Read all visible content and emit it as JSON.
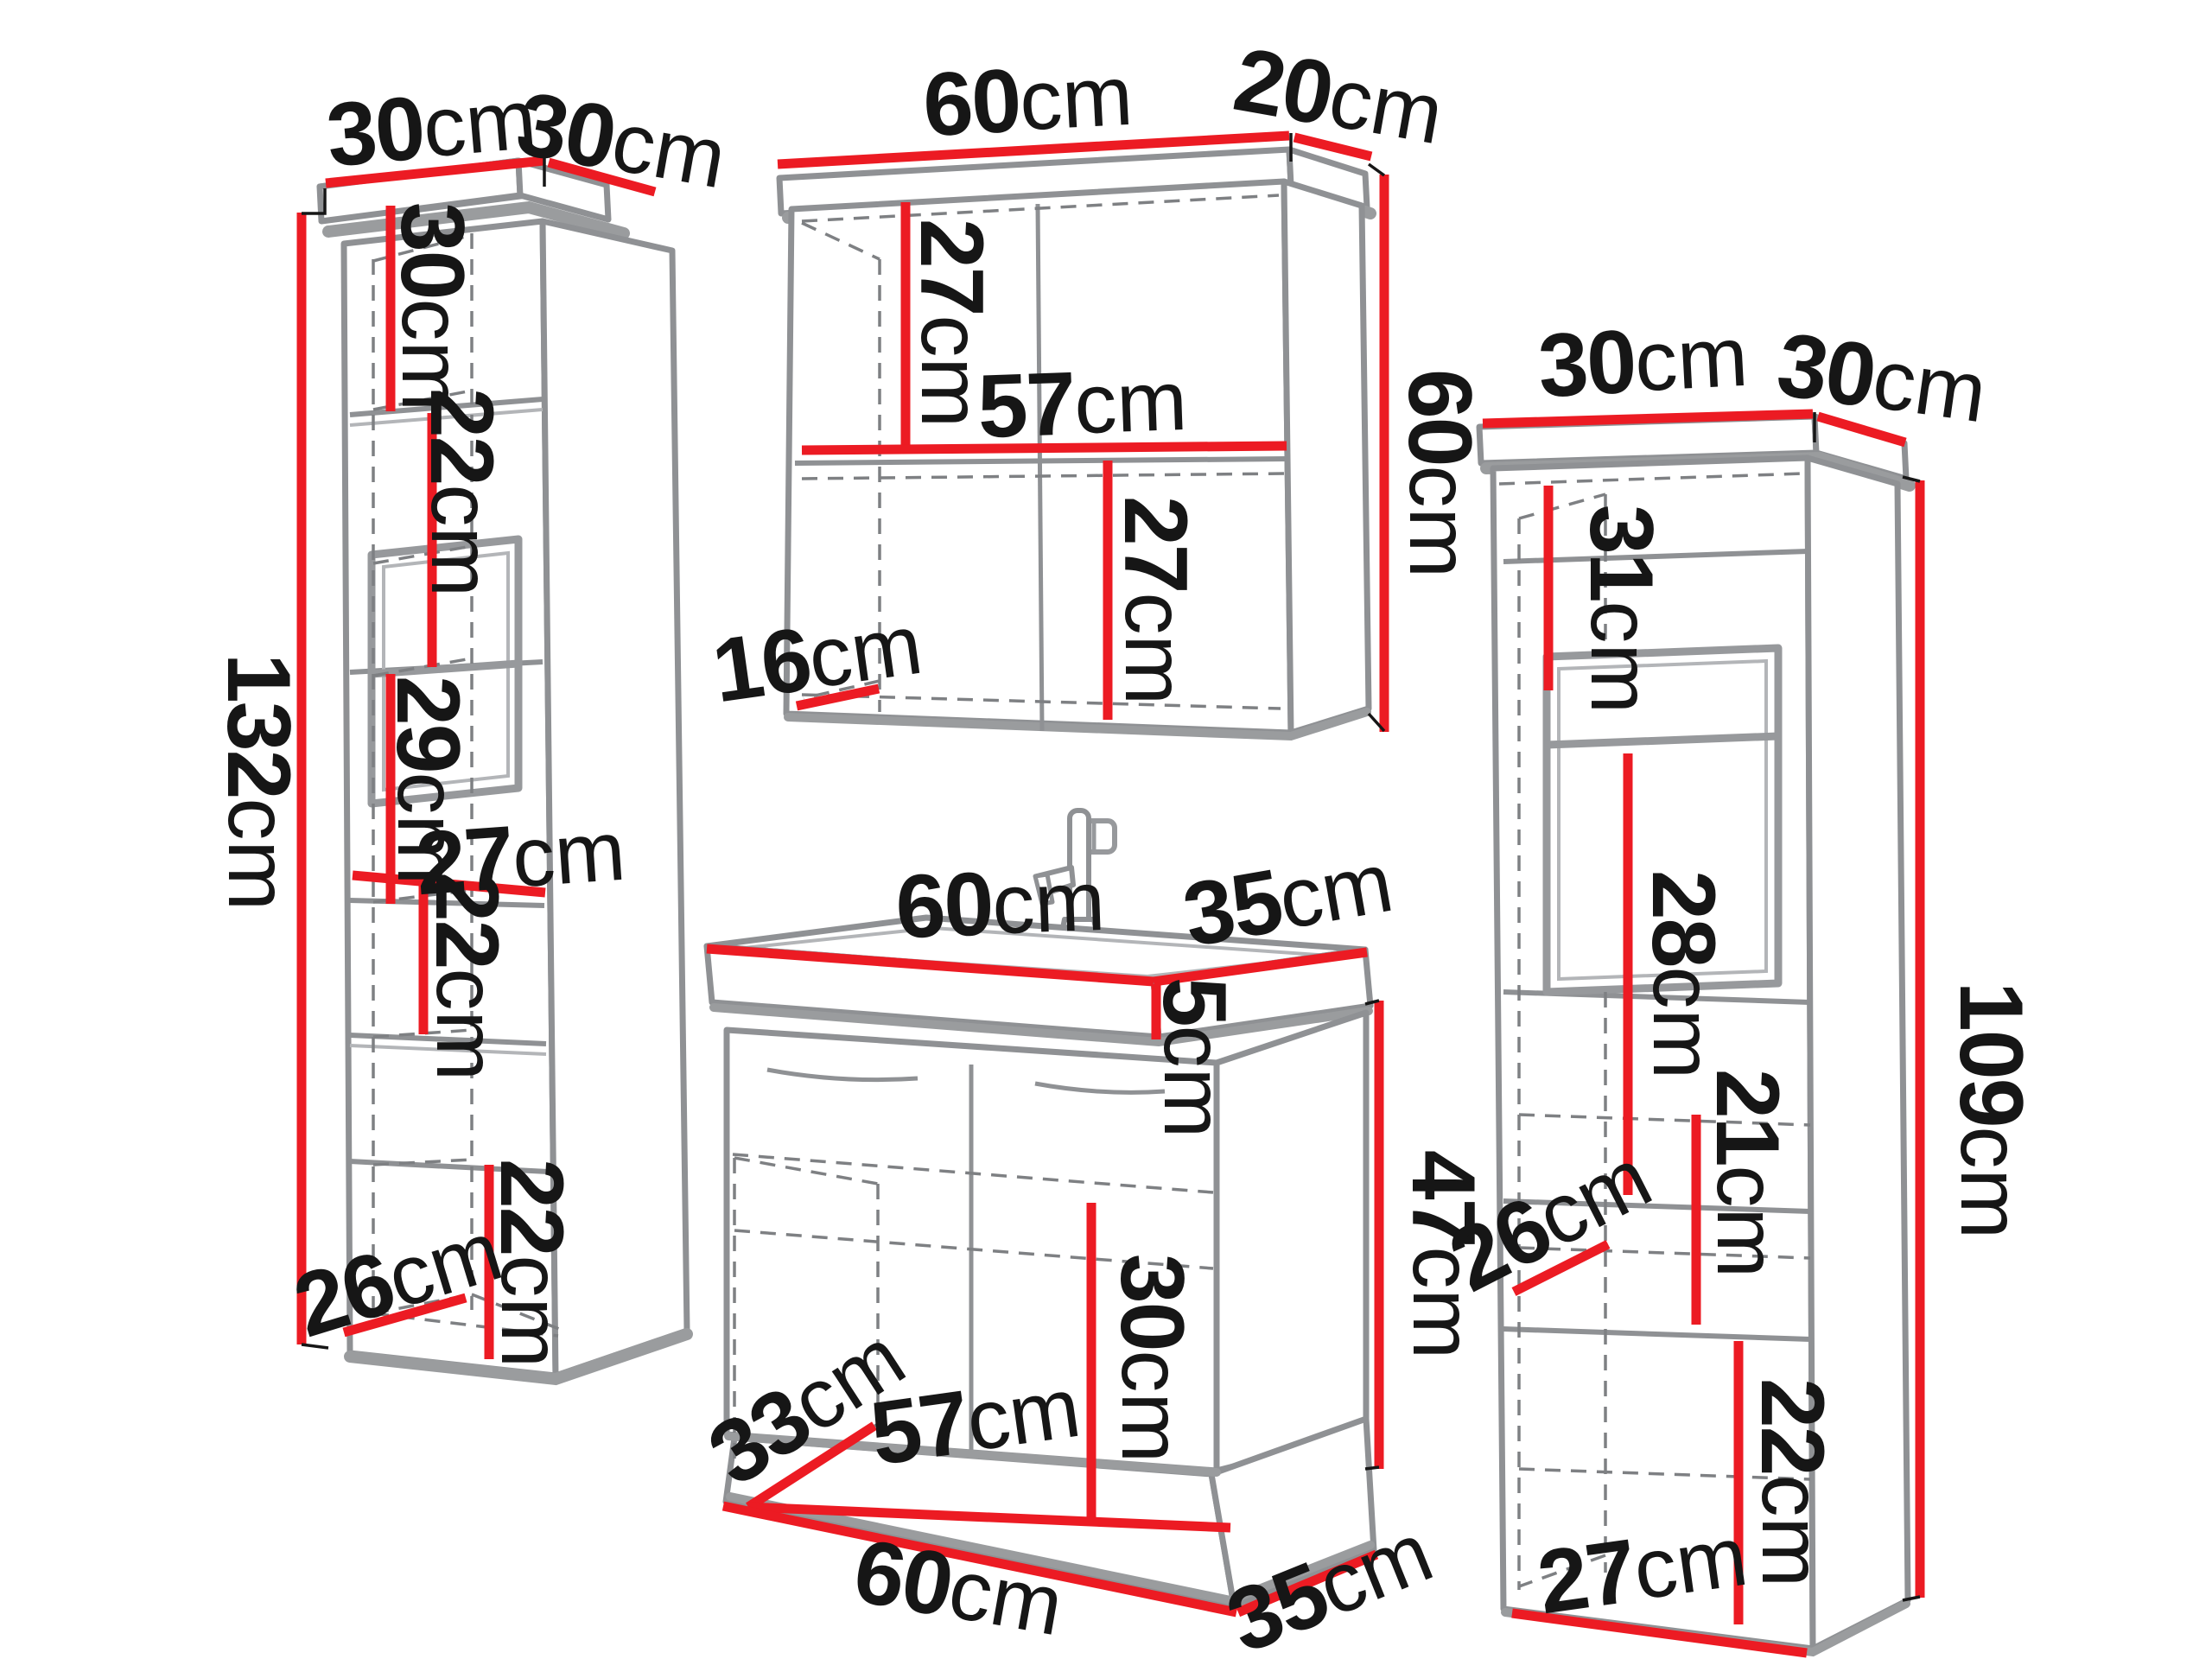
{
  "diagram": {
    "type": "furniture-dimension-diagram",
    "subject": "bathroom furniture set",
    "unit": "cm",
    "accent_color": "#ec1b23",
    "line_color": "#8f9194",
    "text_color": "#161616",
    "icons": {
      "faucet": "faucet-icon",
      "wall_bracket": "wall-mount-bracket-icon"
    },
    "cabinets": [
      {
        "id": "tall-cabinet-left",
        "dims": {
          "top_width": {
            "value": "30",
            "unit": "cm"
          },
          "top_depth": {
            "value": "30",
            "unit": "cm"
          },
          "height": {
            "value": "132",
            "unit": "cm"
          },
          "section_1": {
            "value": "30",
            "unit": "cm"
          },
          "section_2": {
            "value": "22",
            "unit": "cm"
          },
          "section_3": {
            "value": "29",
            "unit": "cm"
          },
          "inner_width": {
            "value": "27",
            "unit": "cm"
          },
          "section_4": {
            "value": "22",
            "unit": "cm"
          },
          "section_5": {
            "value": "22",
            "unit": "cm"
          },
          "inner_depth": {
            "value": "26",
            "unit": "cm"
          }
        }
      },
      {
        "id": "wall-mirror-cabinet",
        "dims": {
          "top_width": {
            "value": "60",
            "unit": "cm"
          },
          "top_depth": {
            "value": "20",
            "unit": "cm"
          },
          "height": {
            "value": "60",
            "unit": "cm"
          },
          "upper_section": {
            "value": "27",
            "unit": "cm"
          },
          "inner_width": {
            "value": "57",
            "unit": "cm"
          },
          "lower_section": {
            "value": "27",
            "unit": "cm"
          },
          "inner_depth": {
            "value": "16",
            "unit": "cm"
          }
        }
      },
      {
        "id": "sink-vanity-cabinet",
        "dims": {
          "top_width": {
            "value": "60",
            "unit": "cm"
          },
          "top_depth": {
            "value": "35",
            "unit": "cm"
          },
          "basin_height": {
            "value": "5",
            "unit": "cm"
          },
          "height": {
            "value": "47",
            "unit": "cm"
          },
          "inner_height": {
            "value": "30",
            "unit": "cm"
          },
          "inner_depth": {
            "value": "33",
            "unit": "cm"
          },
          "inner_width": {
            "value": "57",
            "unit": "cm"
          },
          "bottom_width": {
            "value": "60",
            "unit": "cm"
          },
          "bottom_depth": {
            "value": "35",
            "unit": "cm"
          }
        }
      },
      {
        "id": "tall-cabinet-right",
        "dims": {
          "top_width": {
            "value": "30",
            "unit": "cm"
          },
          "top_depth": {
            "value": "30",
            "unit": "cm"
          },
          "height": {
            "value": "109",
            "unit": "cm"
          },
          "section_1": {
            "value": "31",
            "unit": "cm"
          },
          "section_2": {
            "value": "28",
            "unit": "cm"
          },
          "section_3": {
            "value": "21",
            "unit": "cm"
          },
          "inner_depth": {
            "value": "26",
            "unit": "cm"
          },
          "section_4": {
            "value": "22",
            "unit": "cm"
          },
          "bottom_width": {
            "value": "27",
            "unit": "cm"
          }
        }
      }
    ]
  }
}
